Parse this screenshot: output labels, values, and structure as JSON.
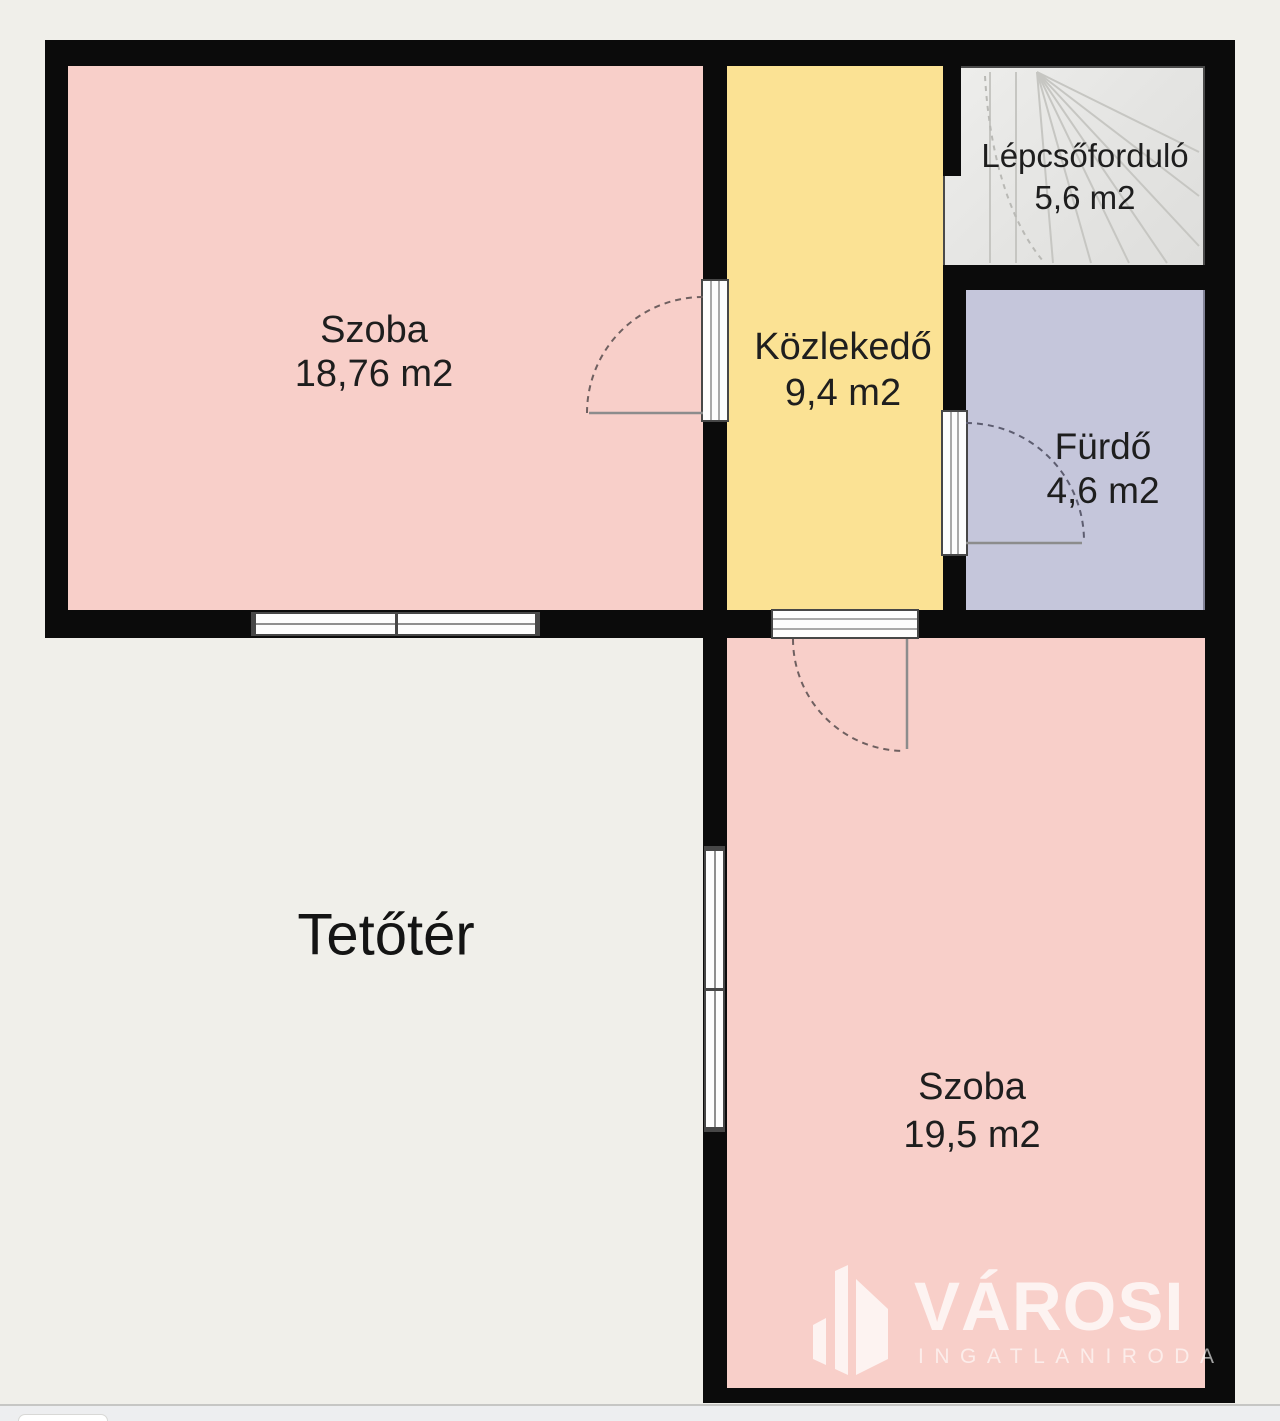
{
  "floorplan": {
    "title": "Tetőtér",
    "rooms": [
      {
        "id": "szoba-1",
        "name": "Szoba",
        "area": "18,76 m2",
        "color": "#f8cfc9"
      },
      {
        "id": "kozlekedo",
        "name": "Közlekedő",
        "area": "9,4 m2",
        "color": "#fbe294"
      },
      {
        "id": "lepcsofordulo",
        "name": "Lépcsőforduló",
        "area": "5,6 m2",
        "color": "#e7e7e5"
      },
      {
        "id": "furdo",
        "name": "Fürdő",
        "area": "4,6 m2",
        "color": "#c5c6db"
      },
      {
        "id": "szoba-2",
        "name": "Szoba",
        "area": "19,5 m2",
        "color": "#f8cfc9"
      },
      {
        "id": "tetoter",
        "name": "Tetőtér",
        "area": "",
        "color": "#f0efea"
      }
    ],
    "wall_color": "#0b0b0b",
    "background_color": "#f0efea"
  },
  "watermark": {
    "brand": "VÁROSI",
    "subtitle": "INGATLANIRODA"
  }
}
